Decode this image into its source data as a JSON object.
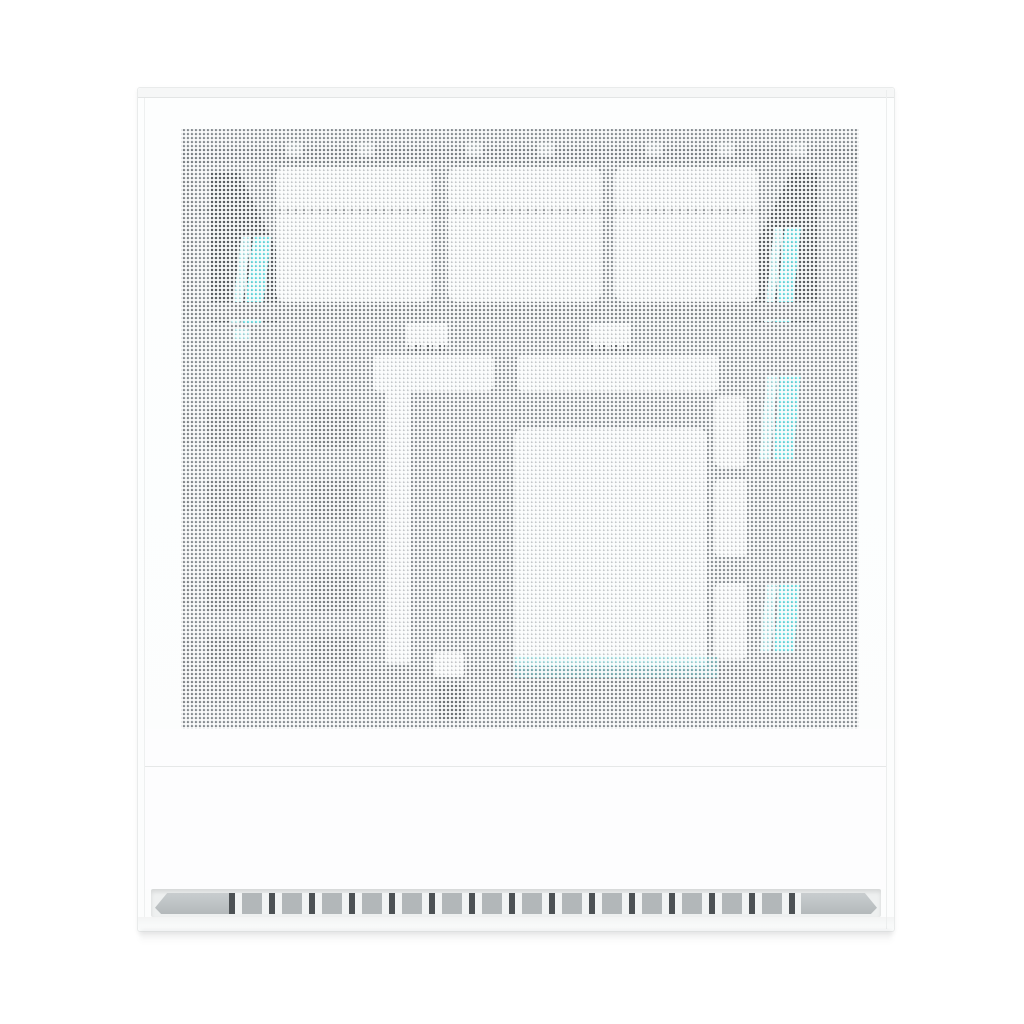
{
  "image": {
    "kind": "product-photo",
    "description": "White mid-tower PC case, direct side view. The perforated mesh side panel reveals three white intake fans along the top, a dark front/rear interior wedge on each side, white motherboard hardware (top bars, vertical front strip, large central plate, rear I/O blocks) and cyan RGB light strips. The lower third of the case is a solid white panel with a horizontal seam, and the base has a recessed ventilation strip of alternating gray slots between two angled bevels.",
    "visible_text": "",
    "fan_count": 3,
    "rgb_strip_count": 5
  },
  "colors": {
    "background": "#ffffff",
    "case_shell": "#fcfdfd",
    "case_edge": "#e9ebeb",
    "mesh_base": "#9aa0a3",
    "component_white": "#f0f2f3",
    "wedge_dark": "#5d6265",
    "rail_dark": "#8f9497",
    "blob_gray": "#83888b",
    "accent_cyan": "#7deef2",
    "accent_cyan_light": "#c6f5f7",
    "vent_slot_gray": "#b2b7b9",
    "vent_slot_dark": "#4d5255",
    "vent_bed": "#eef0f0"
  },
  "scene": {
    "parts": [
      {
        "name": "mesh-side-panel",
        "desc": "fine perforated white mesh covering upper two-thirds"
      },
      {
        "name": "top-fan-row",
        "desc": "three white-framed fans behind mesh"
      },
      {
        "name": "front-wedge",
        "desc": "dark angled interior corner, upper left, with cyan RGB strip"
      },
      {
        "name": "rear-wedge",
        "desc": "dark angled interior corner, upper right, with cyan RGB strip"
      },
      {
        "name": "motherboard-hardware",
        "desc": "white bars, vertical strip, large central plate, rear blocks"
      },
      {
        "name": "rgb-strips",
        "desc": "cyan vertical light strips near rear edge and front"
      },
      {
        "name": "lower-solid-panel",
        "desc": "plain white lower panel with seam line"
      },
      {
        "name": "bottom-vent",
        "desc": "recessed slot row with angled bevel end caps"
      }
    ]
  }
}
